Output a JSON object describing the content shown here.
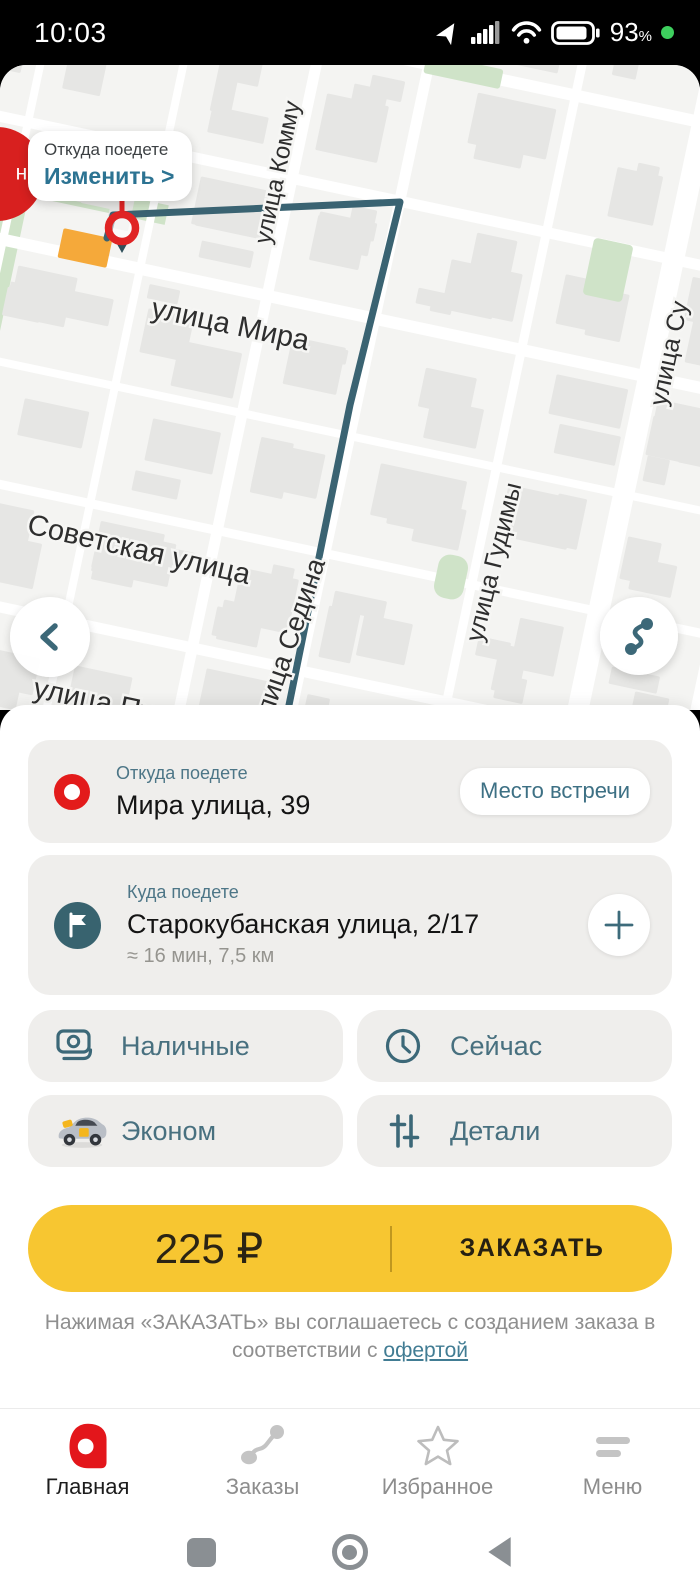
{
  "status_bar": {
    "time": "10:03",
    "battery_percent": "93",
    "percent_sign": "%"
  },
  "map": {
    "street_labels": {
      "kommunarov": "улица Комму",
      "mira": "улица Мира",
      "sovetskaya": "Советская улица",
      "pushkina": "улица Пушкина",
      "sedina": "улица Седина",
      "gudimy": "улица Гудимы",
      "su": "улица Су"
    },
    "pickup_tooltip": {
      "title": "Откуда поедете",
      "action": "Изменить >"
    },
    "badge": "н."
  },
  "sheet": {
    "from": {
      "label": "Откуда поедете",
      "address": "Мира улица, 39",
      "meeting_point_button": "Место встречи"
    },
    "to": {
      "label": "Куда поедете",
      "address": "Старокубанская улица, 2/17",
      "eta": "≈ 16 мин, 7,5 км"
    },
    "options": {
      "payment": "Наличные",
      "when": "Сейчас",
      "tariff": "Эконом",
      "details": "Детали"
    },
    "order": {
      "price": "225 ₽",
      "button": "ЗАКАЗАТЬ"
    },
    "disclaimer": {
      "line1": "Нажимая «ЗАКАЗАТЬ» вы соглашаетесь с созданием заказа в",
      "line2_prefix": "соответствии с",
      "link": "офертой"
    }
  },
  "tabbar": {
    "items": [
      {
        "label": "Главная"
      },
      {
        "label": "Заказы"
      },
      {
        "label": "Избранное"
      },
      {
        "label": "Меню"
      }
    ]
  },
  "colors": {
    "teal_icon": "#3c6878",
    "teal_text": "#48707f",
    "teal_link": "#2c7392",
    "red": "#e31b1b",
    "yellow": "#f7c631",
    "map_green": "#cfe3c8",
    "route": "#3a6372"
  }
}
